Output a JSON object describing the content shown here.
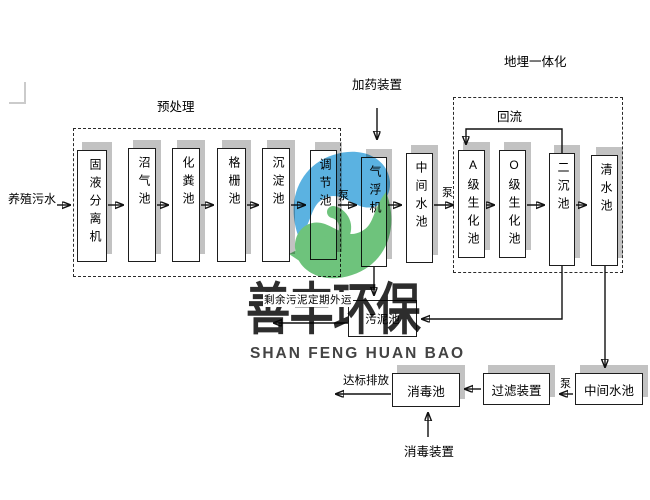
{
  "watermark": {
    "company_cn": "善丰环保",
    "company_en": "SHAN FENG HUAN BAO",
    "logo_blue": "#3fa5dc",
    "logo_green": "#55b966"
  },
  "sections": {
    "pretreatment": "预处理",
    "underground_integrated": "地埋一体化"
  },
  "labels": {
    "input": "养殖污水",
    "pump": "泵",
    "dosing_device": "加药装置",
    "reflux": "回流",
    "sludge_note": "剩余污泥定期外运",
    "discharge": "达标排放",
    "disinfection_device": "消毒装置"
  },
  "tanks": {
    "solid_liquid_separator": "固液分离机",
    "biogas_tank": "沼气池",
    "septic_tank": "化粪池",
    "grid_tank": "格栅池",
    "sedimentation_tank": "沉淀池",
    "regulating_tank": "调节池",
    "air_flotation_machine": "气浮机",
    "intermediate_tank_1": "中间水池",
    "a_grade_bio_tank": "A级生化池",
    "o_grade_bio_tank": "O级生化池",
    "secondary_sedimentation_tank": "二沉池",
    "clear_water_tank": "清水池",
    "sludge_tank": "污泥池",
    "disinfection_tank": "消毒池",
    "filter_device": "过滤装置",
    "intermediate_tank_2": "中间水池"
  }
}
